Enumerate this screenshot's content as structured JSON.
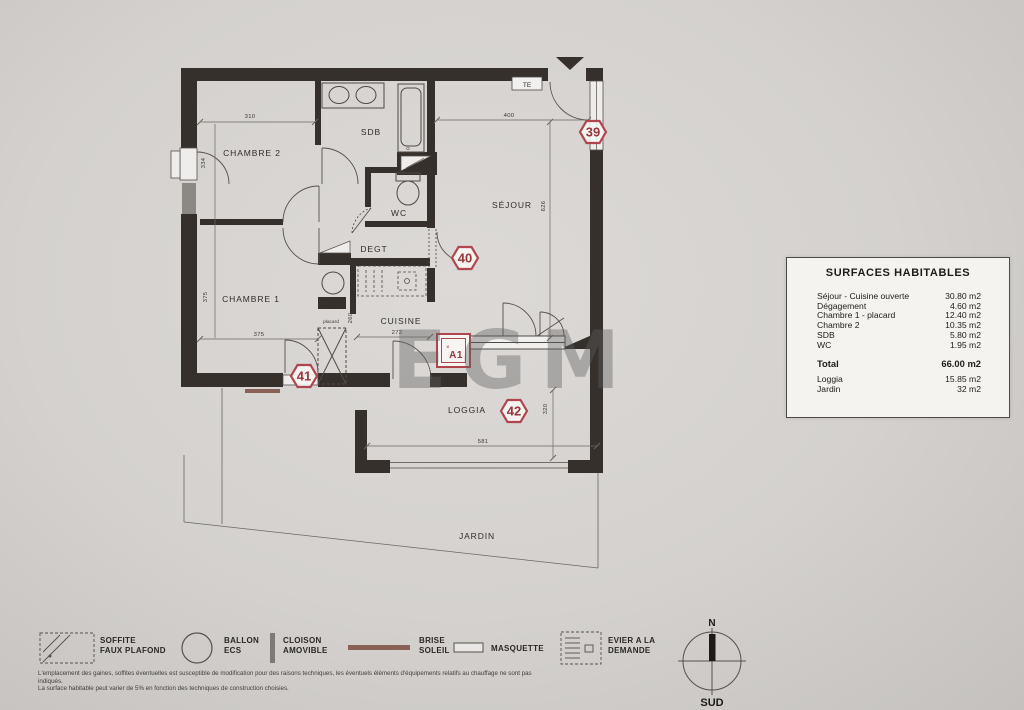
{
  "watermark": "EGM",
  "plan": {
    "rooms": {
      "chambre2": "CHAMBRE 2",
      "sdb": "SDB",
      "wc": "WC",
      "sejour": "SÉJOUR",
      "degt": "DEGT",
      "chambre1": "CHAMBRE 1",
      "cuisine": "CUISINE",
      "loggia": "LOGGIA",
      "jardin": "JARDIN"
    },
    "annotations": {
      "te": "TE",
      "placard": "placard",
      "g": "G",
      "a1": "A1",
      "a1_prefix": "×"
    },
    "dimensions": {
      "chambre2_width": "310",
      "chambre2_window": "334",
      "sejour_width": "400",
      "sejour_depth": "626",
      "chambre1_depth": "375",
      "chambre1_width": "375",
      "cuisine_width": "272",
      "placard_depth": "260",
      "loggia_width": "581",
      "loggia_depth": "320"
    },
    "markers": {
      "m39": "39",
      "m40": "40",
      "m41": "41",
      "m42": "42"
    },
    "compass": {
      "north": "N",
      "south": "SUD"
    }
  },
  "surfaces_table": {
    "title": "SURFACES HABITABLES",
    "rows": [
      {
        "label": "Séjour - Cuisine ouverte",
        "value": "30.80 m2"
      },
      {
        "label": "Dégagement",
        "value": "4.60 m2"
      },
      {
        "label": "Chambre 1 - placard",
        "value": "12.40 m2"
      },
      {
        "label": "Chambre 2",
        "value": "10.35 m2"
      },
      {
        "label": "SDB",
        "value": "5.80 m2"
      },
      {
        "label": "WC",
        "value": "1.95 m2"
      }
    ],
    "total": {
      "label": "Total",
      "value": "66.00 m2"
    },
    "extra_rows": [
      {
        "label": "Loggia",
        "value": "15.85 m2"
      },
      {
        "label": "Jardin",
        "value": "32 m2"
      }
    ]
  },
  "legend": {
    "items": [
      {
        "line1": "SOFFITE",
        "line2": "FAUX PLAFOND"
      },
      {
        "line1": "BALLON",
        "line2": "ECS"
      },
      {
        "line1": "CLOISON",
        "line2": "AMOVIBLE"
      },
      {
        "line1": "BRISE",
        "line2": "SOLEIL"
      },
      {
        "line1": "MASQUETTE",
        "line2": ""
      },
      {
        "line1": "EVIER A LA",
        "line2": "DEMANDE"
      }
    ]
  },
  "disclaimer": {
    "line1": "L'emplacement des gaines, soffites éventuelles est susceptible de modification pour des raisons techniques, les éventuels éléments d'équipements relatifs au chauffage ne sont pas indiqués.",
    "line2": "La surface habitable peut varier de 5% en fonction des techniques de construction choisies."
  },
  "colors": {
    "marker_red": "#b0464d",
    "marker_text": "#9b333c",
    "wall": "#35302c",
    "brise_brown": "#8a6157"
  }
}
